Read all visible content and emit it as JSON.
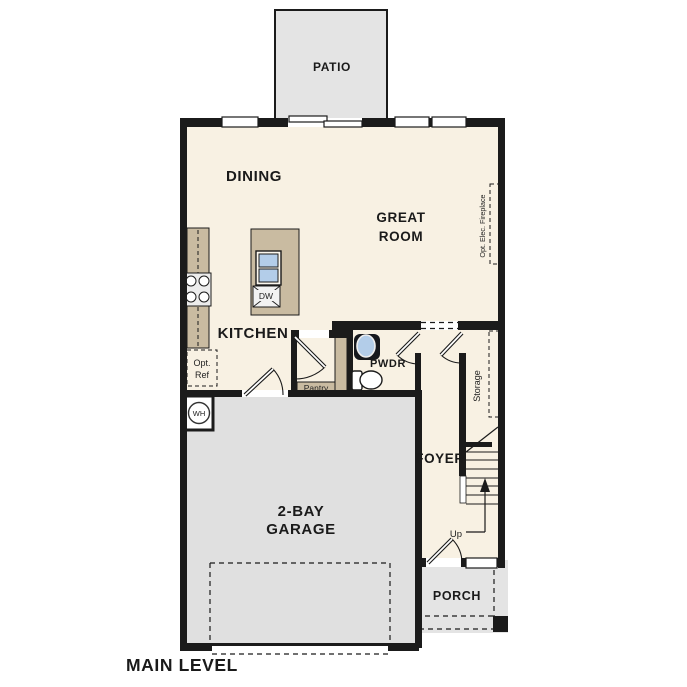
{
  "plan": {
    "title": "MAIN LEVEL",
    "rooms": {
      "patio": "PATIO",
      "dining": "DINING",
      "great_room": [
        "GREAT",
        "ROOM"
      ],
      "kitchen": "KITCHEN",
      "powder": "PWDR",
      "pantry": "Pantry",
      "foyer": "FOYER",
      "storage": "Storage",
      "garage": [
        "2-BAY",
        "GARAGE"
      ],
      "porch": "PORCH"
    },
    "annotations": {
      "up": "Up",
      "water_heater": "WH",
      "dishwasher": "DW",
      "optional_refrigerator": [
        "Opt.",
        "Ref"
      ],
      "optional_fireplace": "Opt. Elec. Fireplace"
    },
    "colors": {
      "floor": "#f8f1e3",
      "outdoor_concrete": "#e4e4e4",
      "garage_floor": "#e0e0e0",
      "cabinetry": "#c9bba1",
      "wall": "#1b1b1b",
      "sink_blue": "#b3cde9"
    }
  }
}
